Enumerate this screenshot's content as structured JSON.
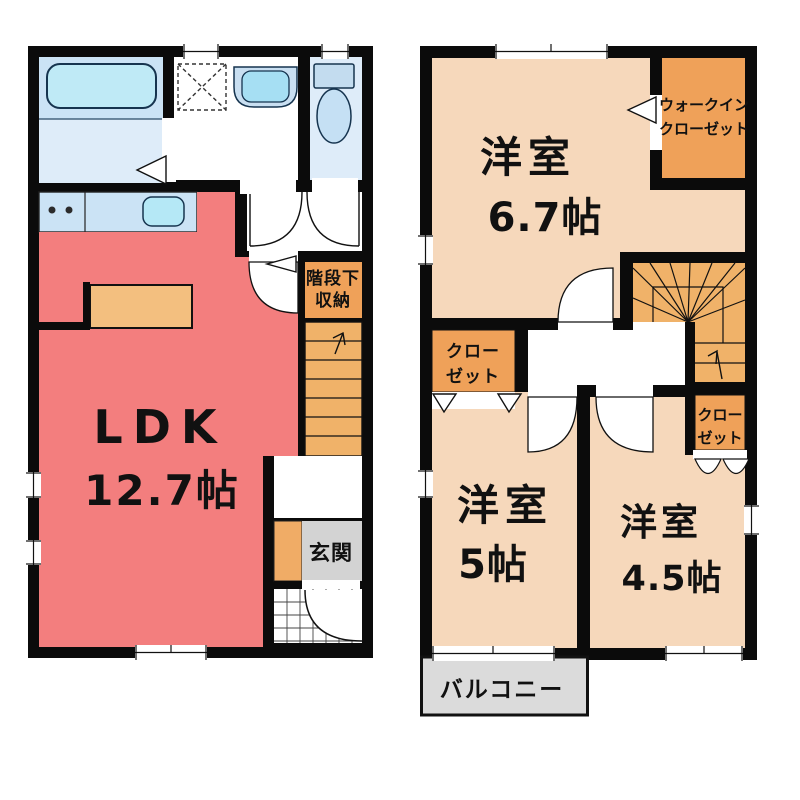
{
  "floor1": {
    "ldk": {
      "name": "LDK",
      "size": "12.7帖"
    },
    "understairs": {
      "line1": "階段下",
      "line2": "収納"
    },
    "entrance": {
      "label": "玄関"
    }
  },
  "floor2": {
    "room67": {
      "name": "洋室",
      "size": "6.7帖"
    },
    "wic": {
      "line1": "ウォークイン",
      "line2": "クローゼット"
    },
    "closet_left": {
      "line1": "クロー",
      "line2": "ゼット"
    },
    "closet_right": {
      "line1": "クロー",
      "line2": "ゼット"
    },
    "room5": {
      "name": "洋室",
      "size": "5帖"
    },
    "room45": {
      "name": "洋室",
      "size": "4.5帖"
    },
    "balcony": {
      "label": "バルコニー"
    }
  },
  "colors": {
    "wall": "#0b0b0b",
    "ldk_salmon": "#F37E7E",
    "room_peach": "#F6D8BB",
    "closet_orange": "#EFA159",
    "stairs_orange": "#F0B269",
    "counter_orange": "#F3BF7F",
    "water_blue": "#CBE3F5",
    "floor_blue": "#DEECF9",
    "fixture_cyan": "#B5E8F6",
    "tub_cyan": "#BFEAF6",
    "entry_gray": "#D3D3D3",
    "balcony_gray": "#DBDBDB"
  }
}
